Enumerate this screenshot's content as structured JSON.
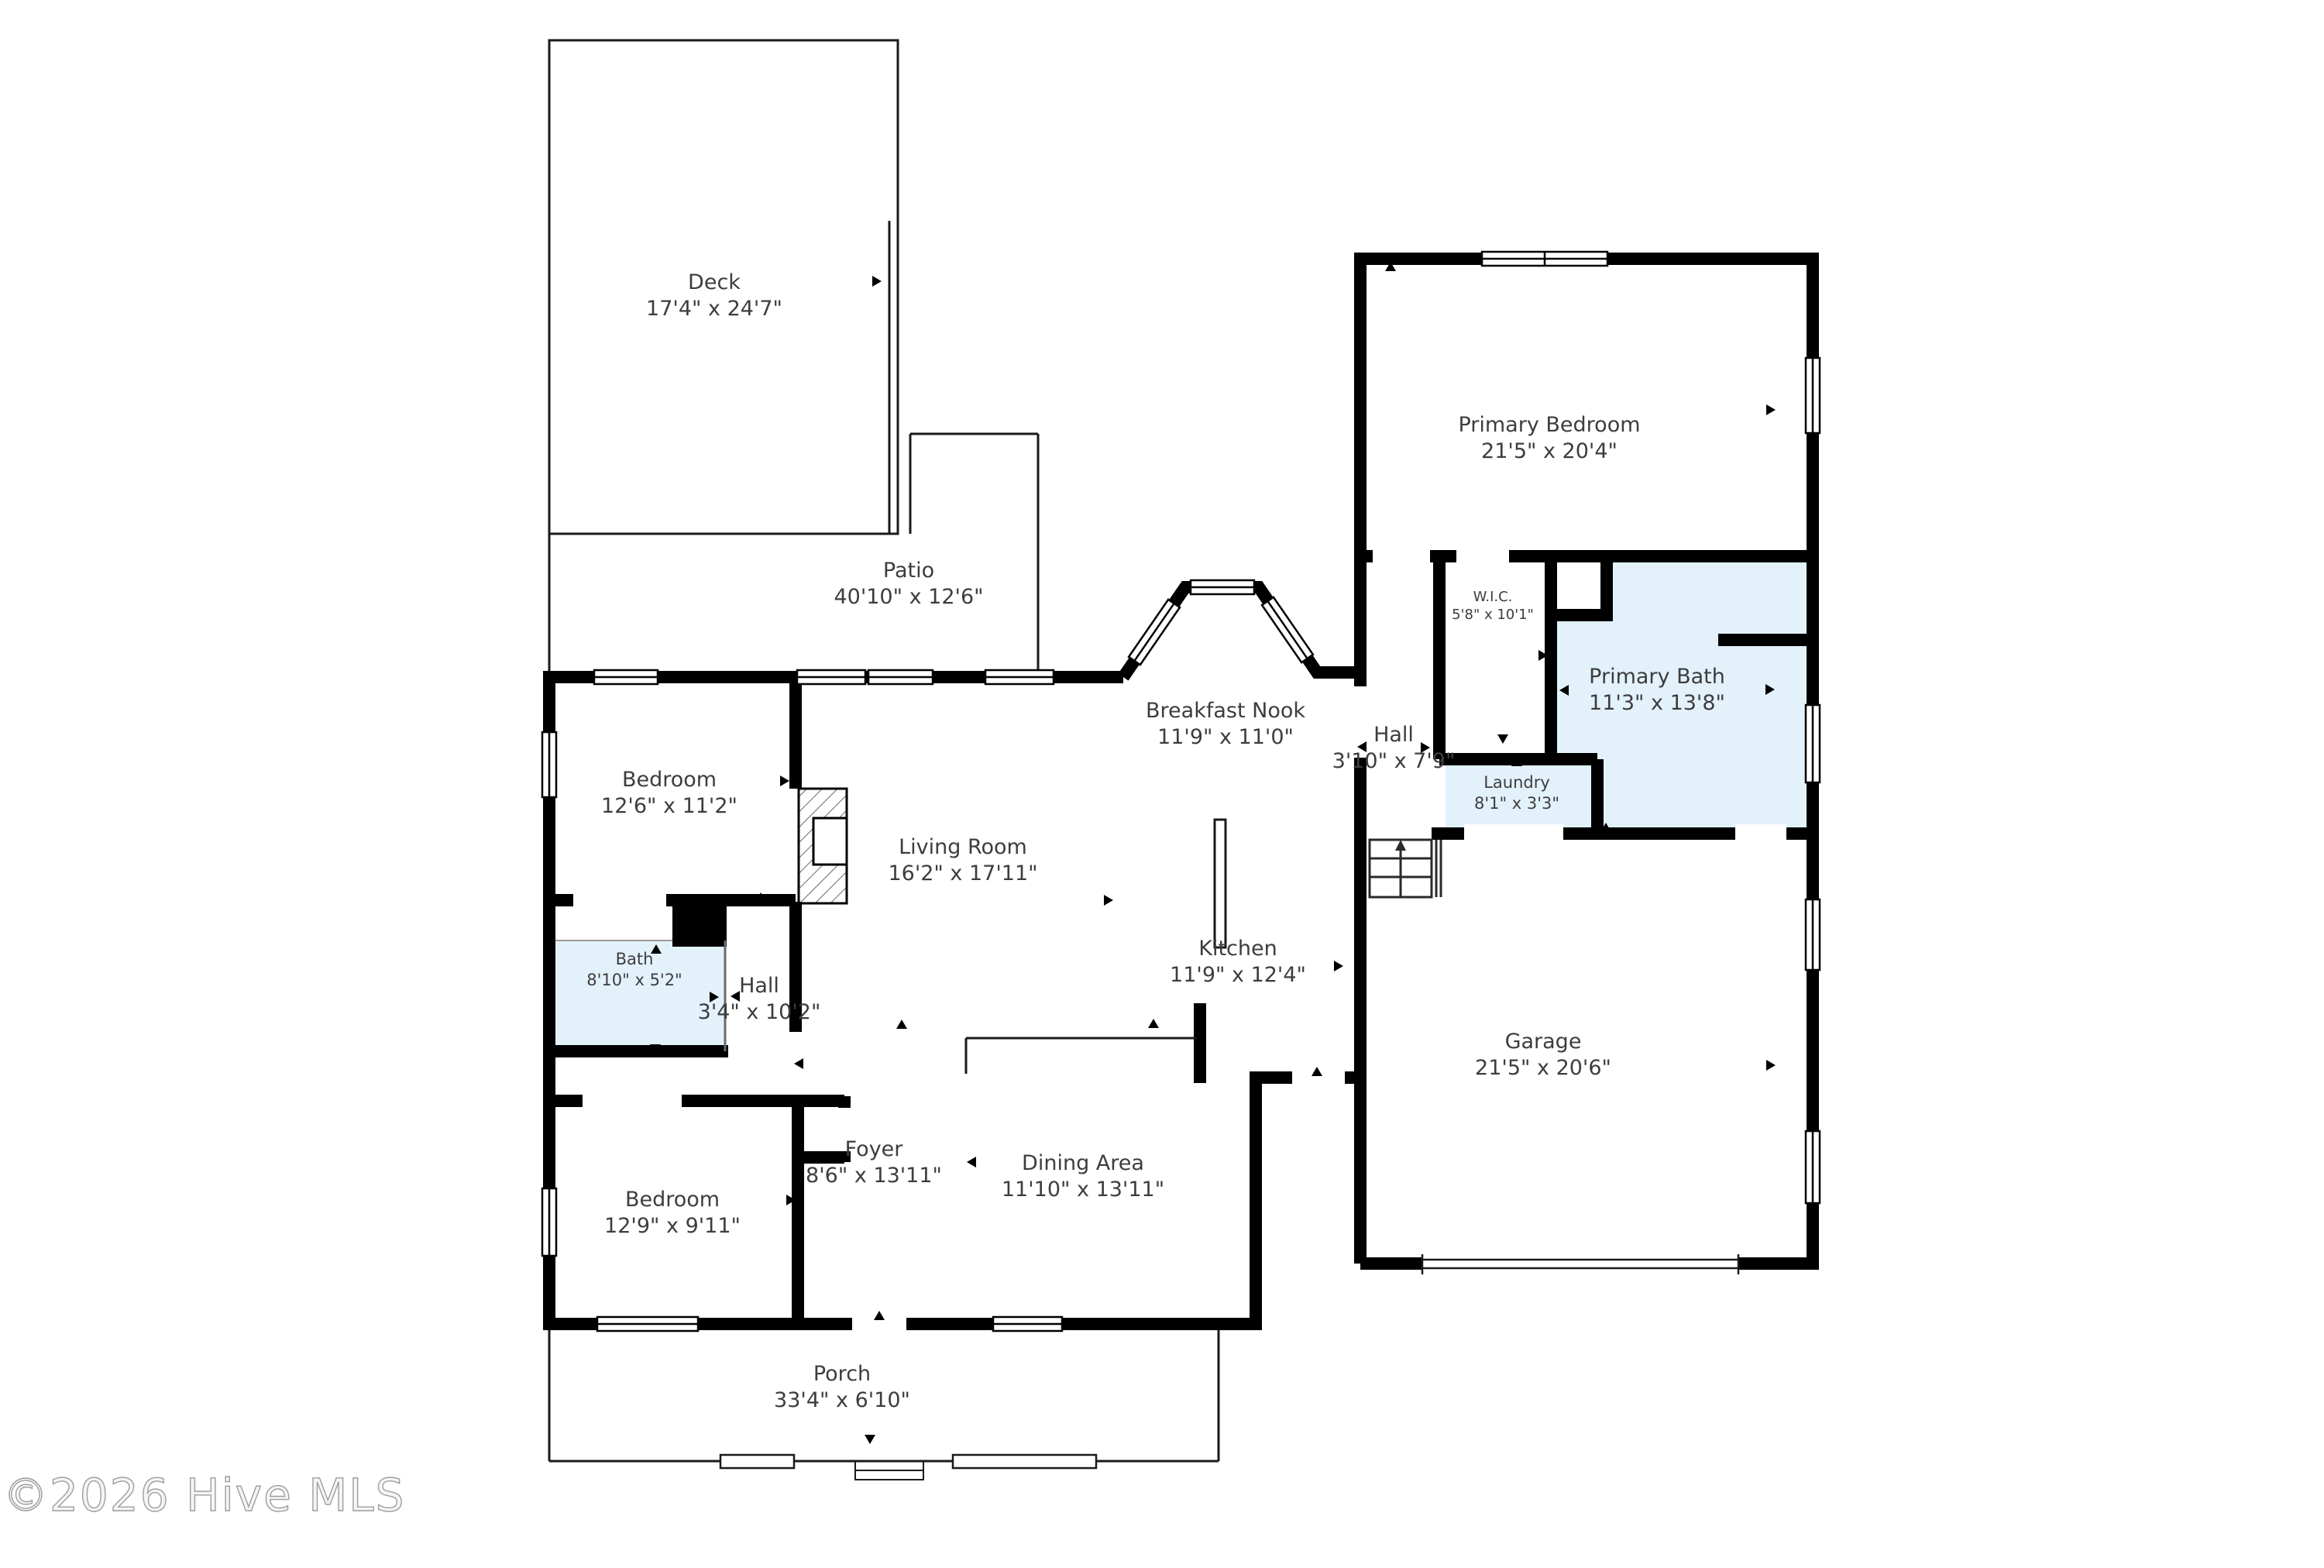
{
  "watermark": "©2026 Hive MLS",
  "colors": {
    "wall": "#000000",
    "wet_room_fill": "#e3f1fb",
    "label_text": "#3d3d3d",
    "watermark_outline": "#9e9e9e"
  },
  "rooms": [
    {
      "name": "Deck",
      "dims": "17'4\" x 24'7\""
    },
    {
      "name": "Patio",
      "dims": "40'10\" x 12'6\""
    },
    {
      "name": "Primary Bedroom",
      "dims": "21'5\" x 20'4\""
    },
    {
      "name": "W.I.C.",
      "dims": "5'8\" x 10'1\""
    },
    {
      "name": "Primary Bath",
      "dims": "11'3\" x 13'8\""
    },
    {
      "name": "Hall",
      "dims": "3'10\" x 7'9\""
    },
    {
      "name": "Laundry",
      "dims": "8'1\" x 3'3\""
    },
    {
      "name": "Breakfast Nook",
      "dims": "11'9\" x 11'0\""
    },
    {
      "name": "Bedroom",
      "dims": "12'6\" x 11'2\""
    },
    {
      "name": "Living Room",
      "dims": "16'2\" x 17'11\""
    },
    {
      "name": "Kitchen",
      "dims": "11'9\" x 12'4\""
    },
    {
      "name": "Bath",
      "dims": "8'10\" x 5'2\""
    },
    {
      "name": "Hall",
      "dims": "3'4\" x 10'2\""
    },
    {
      "name": "Garage",
      "dims": "21'5\" x 20'6\""
    },
    {
      "name": "Foyer",
      "dims": "8'6\" x 13'11\""
    },
    {
      "name": "Dining Area",
      "dims": "11'10\" x 13'11\""
    },
    {
      "name": "Bedroom",
      "dims": "12'9\" x 9'11\""
    },
    {
      "name": "Porch",
      "dims": "33'4\" x 6'10\""
    }
  ]
}
